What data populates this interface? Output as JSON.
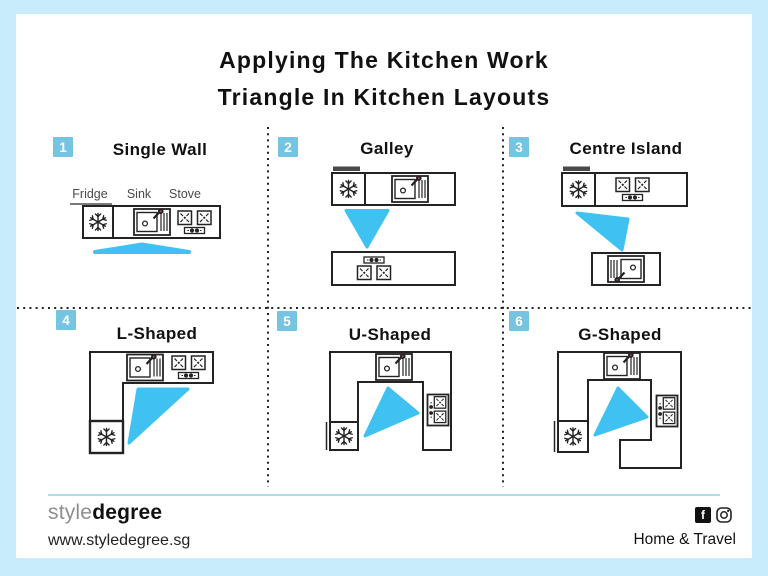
{
  "page": {
    "background": "#c9ecfd",
    "card_background": "#ffffff"
  },
  "title": {
    "line1": "Applying The Kitchen Work",
    "line2": "Triangle In Kitchen Layouts"
  },
  "colors": {
    "work_triangle_blue": "#3fc1f2",
    "badge_blue": "#74c4e2",
    "outline_black": "#232323",
    "label_gray": "#4a4a4a",
    "footer_rule_blue": "#a9ddf2",
    "faucet_red": "#e05252"
  },
  "panels": [
    {
      "number": "1",
      "title": "Single Wall",
      "labels": {
        "fridge": "Fridge",
        "sink": "Sink",
        "stove": "Stove"
      },
      "appliances": [
        "fridge",
        "sink",
        "stove"
      ]
    },
    {
      "number": "2",
      "title": "Galley",
      "appliances": [
        "fridge",
        "sink",
        "stove"
      ]
    },
    {
      "number": "3",
      "title": "Centre Island",
      "appliances": [
        "fridge",
        "stove",
        "sink"
      ]
    },
    {
      "number": "4",
      "title": "L-Shaped",
      "appliances": [
        "sink",
        "stove",
        "fridge"
      ]
    },
    {
      "number": "5",
      "title": "U-Shaped",
      "appliances": [
        "sink",
        "stove",
        "fridge"
      ]
    },
    {
      "number": "6",
      "title": "G-Shaped",
      "appliances": [
        "sink",
        "stove",
        "fridge"
      ]
    }
  ],
  "icons": {
    "fridge": "snowflake-icon",
    "sink": "sink-icon",
    "stove": "stove-burners-icon",
    "work_triangle": "work-triangle-shape",
    "facebook": "facebook-icon",
    "facebook_glyph": "f",
    "instagram": "instagram-icon"
  },
  "footer": {
    "brand_light": "style",
    "brand_bold": "degree",
    "website": "www.styledegree.sg",
    "category": "Home & Travel"
  }
}
